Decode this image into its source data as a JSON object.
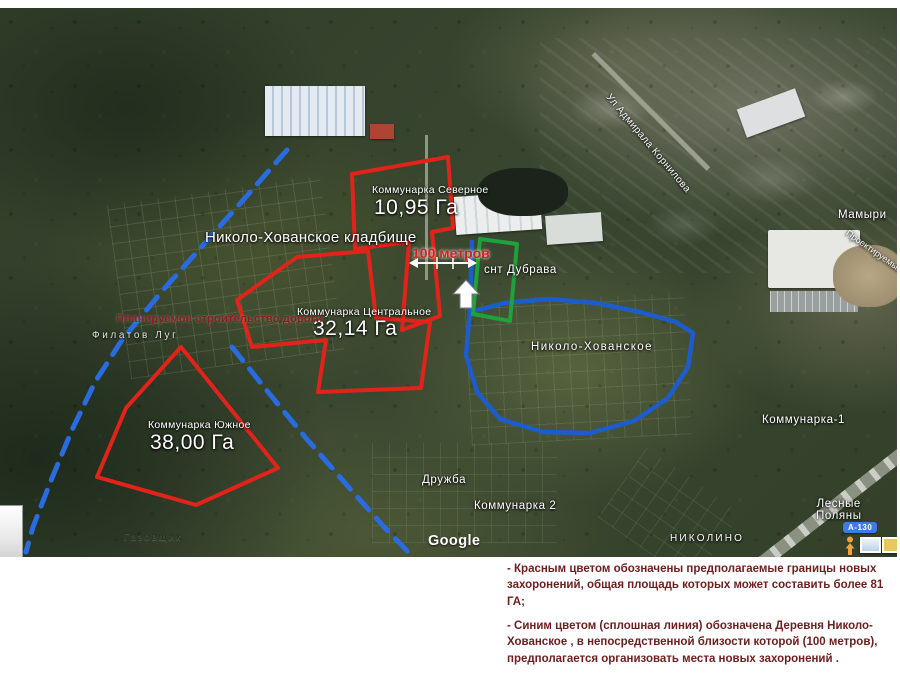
{
  "map": {
    "attribution": "Google",
    "labels": {
      "cemetery": "Николо-Хованское кладбище",
      "village": "Николо-Хованское",
      "snt_dubrava": "снт Дубрава",
      "druzhba": "Дружба",
      "kommunarka2": "Коммунарка 2",
      "kommunarka1": "Коммунарка-1",
      "nikolino": "НИКОЛИНО",
      "lesnye_polyany": "Лесные\nПоляны",
      "mamyri": "Мамыри",
      "filatov_lug": "Филатов Луг",
      "gazovshchik": "Газовщик",
      "admirala_kornilova": "Ул Адмирала Корнилова",
      "proektiruemyy": "Проектируемый",
      "road_badge": "А-130"
    },
    "annotations": {
      "planned_road_label": "Планируемое строительство дороги",
      "scale_label": "100 метров",
      "areas": [
        {
          "name": "Коммунарка Северное",
          "value": "10,95 Га"
        },
        {
          "name": "Коммунарка Центральное",
          "value": "32,14 Га"
        },
        {
          "name": "Коммунарка Южное",
          "value": "38,00 Га"
        }
      ],
      "colors": {
        "red_boundary": "#e2231a",
        "blue_line": "#2a6bdf",
        "green_boundary": "#1fa23c"
      }
    }
  },
  "legend": {
    "items": [
      "- Красным цветом обозначены предполагаемые границы новых захоронений, общая площадь которых может  составить более 81 ГА;",
      "- Синим цветом (сплошная линия) обозначена Деревня Николо-Хованское , в непосредственной близости которой (100 метров), предполагается организовать места новых захоронений ."
    ]
  }
}
